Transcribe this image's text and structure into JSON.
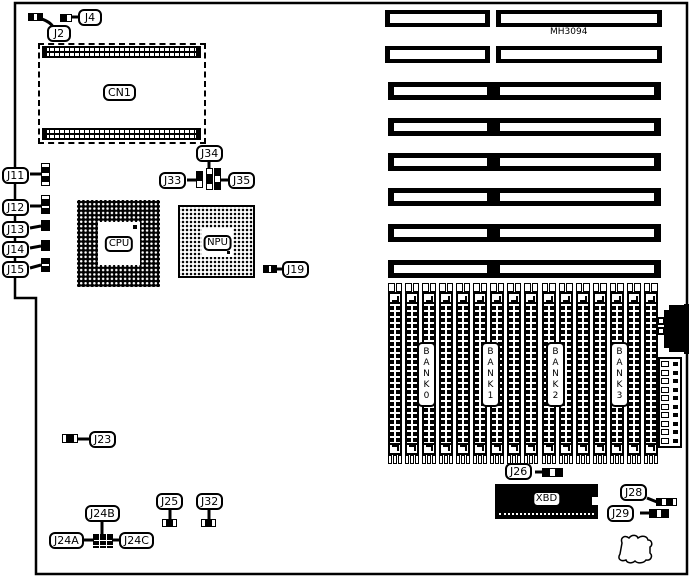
{
  "board": {
    "model": "MH3094",
    "background_color": "#ffffff",
    "line_color": "#000000"
  },
  "chips": {
    "cn1": "CN1",
    "cpu": "CPU",
    "npu": "NPU",
    "xbd": "XBD"
  },
  "jumpers": {
    "j2": "J2",
    "j4": "J4",
    "j11": "J11",
    "j12": "J12",
    "j13": "J13",
    "j14": "J14",
    "j15": "J15",
    "j19": "J19",
    "j23": "J23",
    "j24a": "J24A",
    "j24b": "J24B",
    "j24c": "J24C",
    "j25": "J25",
    "j26": "J26",
    "j28": "J28",
    "j29": "J29",
    "j32": "J32",
    "j33": "J33",
    "j34": "J34",
    "j35": "J35"
  },
  "memory": {
    "bank_labels": [
      "BANK0",
      "BANK1",
      "BANK2",
      "BANK3"
    ],
    "socket_count": 16
  },
  "expansion": {
    "slot_row_count": 8,
    "split_row_count": 2,
    "joined_row_count": 6
  }
}
